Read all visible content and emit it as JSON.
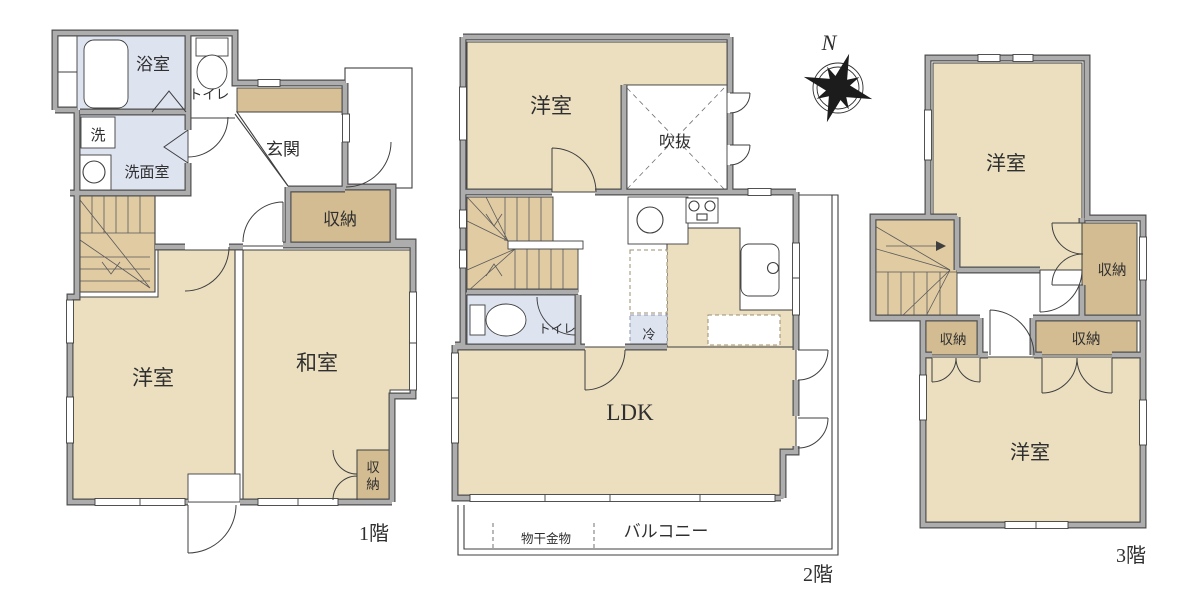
{
  "colors": {
    "room": "#EBDFC0",
    "closet": "#D3BC92",
    "stairs": "#E0CBA3",
    "water": "#DEE3F0",
    "step": "#D8C096",
    "wall_fill": "#ADADAD",
    "wall_edge": "#4F4F4F",
    "line": "#3F3F3F",
    "text": "#2F2F2F"
  },
  "compass": {
    "north_label": "N"
  },
  "floor1": {
    "floor_label": "1階",
    "bath": "浴室",
    "toilet": "トイレ",
    "laundry": "洗",
    "washroom": "洗面室",
    "entrance": "玄関",
    "hall_storage": "収納",
    "western_room": "洋室",
    "japanese_room": "和室",
    "tatami_storage_char1": "収",
    "tatami_storage_char2": "納"
  },
  "floor2": {
    "floor_label": "2階",
    "western_room": "洋室",
    "atrium": "吹抜",
    "toilet": "トイレ",
    "refrigerator": "冷",
    "ldk": "LDK",
    "balcony": "バルコニー",
    "laundry_hardware": "物干金物"
  },
  "floor3": {
    "floor_label": "3階",
    "western_room_north": "洋室",
    "western_room_south": "洋室",
    "storage_east": "収納",
    "storage_left": "収納",
    "storage_center": "収納"
  }
}
